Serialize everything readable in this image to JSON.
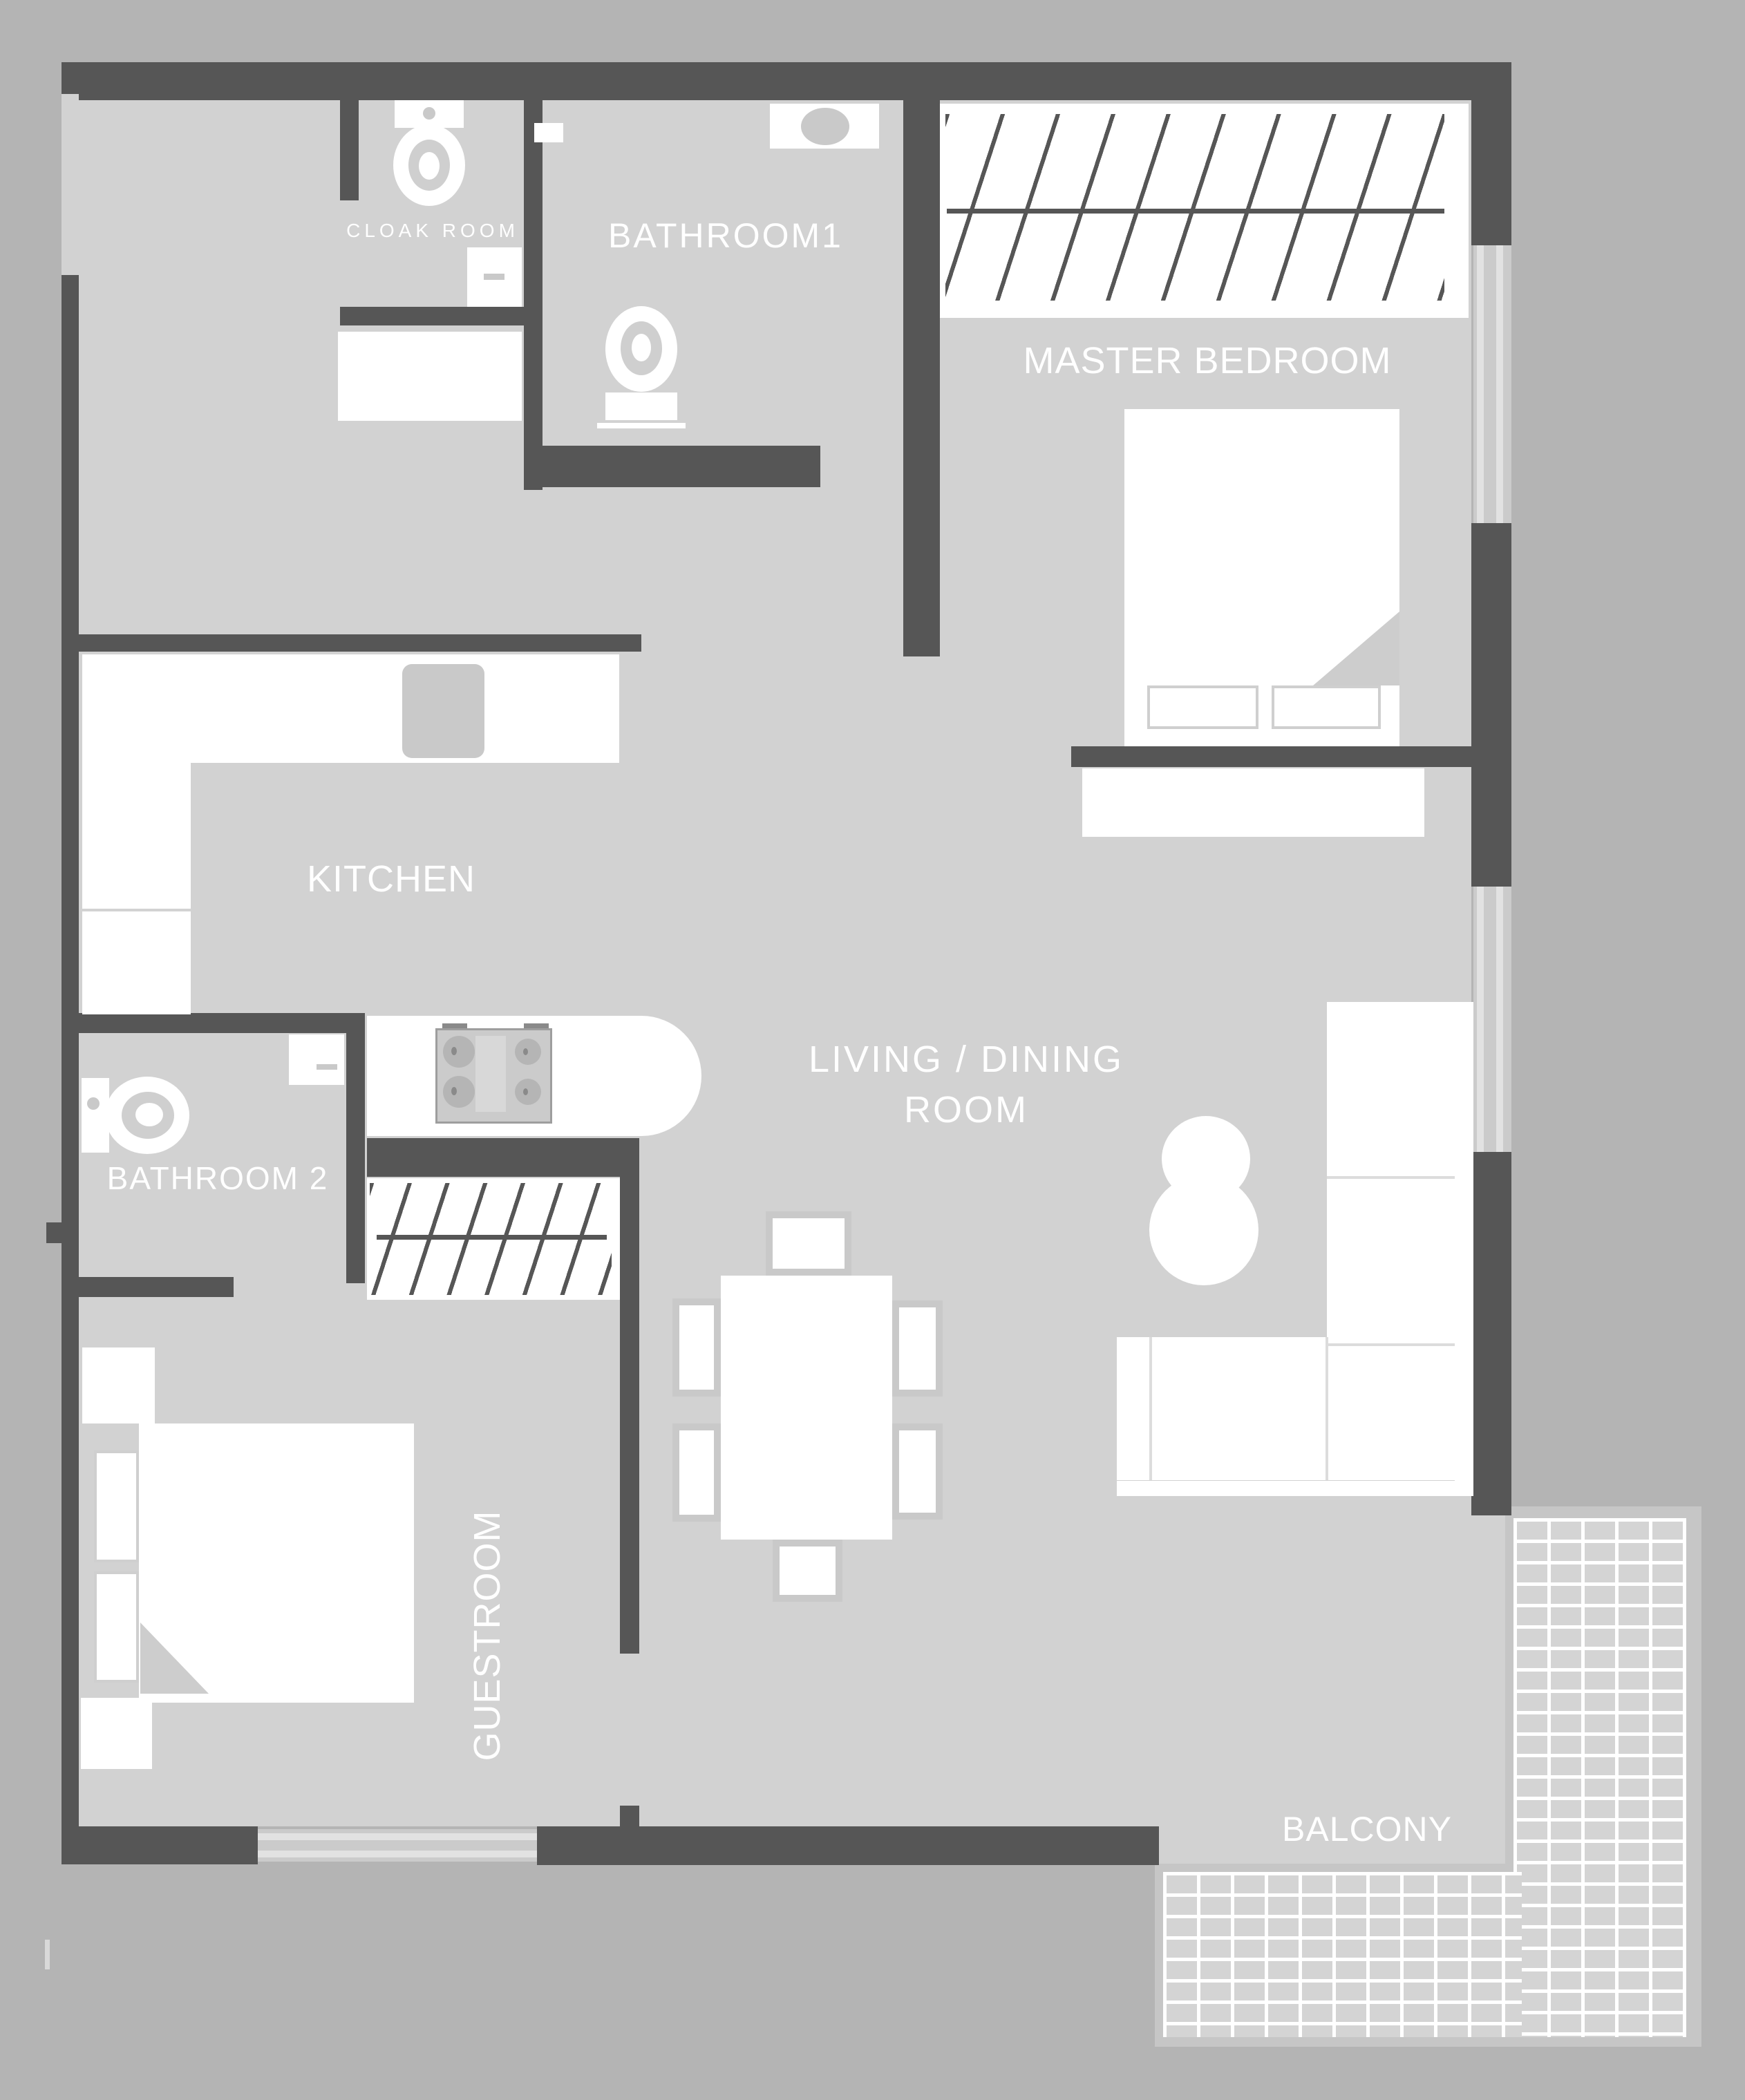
{
  "document": {
    "type": "apartment-floor-plan"
  },
  "colors": {
    "outside": "#b4b4b4",
    "floor": "#d2d2d2",
    "wall": "#565656",
    "furniture": "#ffffff",
    "furniture_outline": "#c9c9c9",
    "window": "#cbcbcb",
    "label_text": "#ffffff"
  },
  "rooms": {
    "cloak_room": {
      "label": "CLOAK ROOM"
    },
    "bathroom1": {
      "label": "BATHROOM1"
    },
    "master_bedroom": {
      "label": "MASTER BEDROOM"
    },
    "kitchen": {
      "label": "KITCHEN"
    },
    "living_dining": {
      "label_line1": "LIVING / DINING",
      "label_line2": "ROOM"
    },
    "bathroom2": {
      "label": "BATHROOM 2"
    },
    "guestroom": {
      "label": "GUESTROOM"
    },
    "balcony": {
      "label": "BALCONY"
    }
  },
  "fixtures": {
    "icons": [
      "toilet-icon",
      "sink-icon",
      "stove-icon",
      "bed-icon",
      "pillow-icon",
      "wardrobe-hatch-icon",
      "sofa-icon",
      "side-table-icon",
      "dining-table-icon",
      "chair-icon",
      "counter-icon",
      "dresser-icon",
      "nightstand-icon",
      "balcony-tiles-icon",
      "window-icon"
    ]
  }
}
